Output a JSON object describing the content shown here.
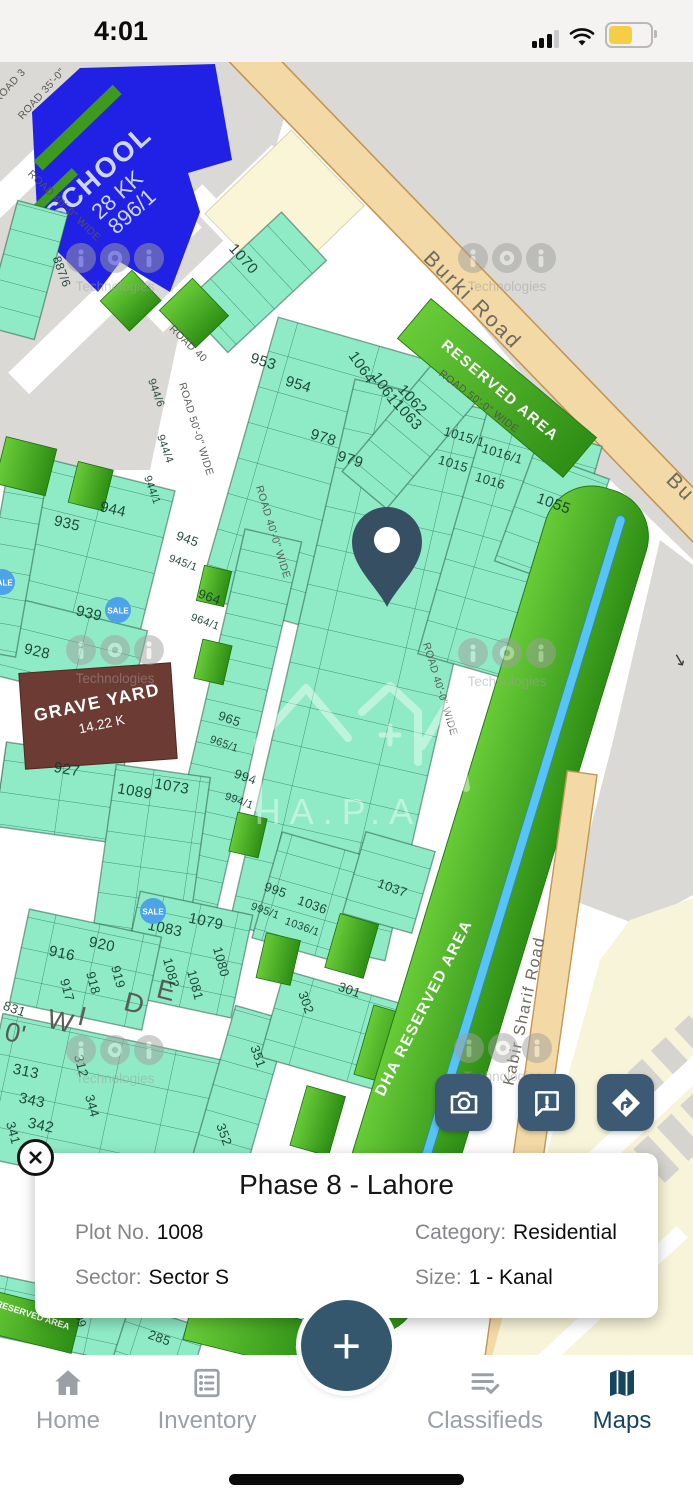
{
  "status_bar": {
    "time": "4:01"
  },
  "map": {
    "plots": [
      "1070",
      "953",
      "954",
      "1064",
      "1061",
      "1062",
      "1063",
      "978",
      "979",
      "1015/1",
      "1016/1",
      "1015",
      "1016",
      "1055",
      "935",
      "944",
      "939",
      "928",
      "945",
      "945/1",
      "964",
      "964/1",
      "965",
      "965/1",
      "994",
      "994/1",
      "995",
      "995/1",
      "1036",
      "1036/1",
      "1037",
      "927",
      "1089",
      "1073",
      "916",
      "920",
      "917",
      "918",
      "919",
      "1083",
      "1079",
      "1082",
      "1081",
      "1080",
      "831",
      "313",
      "343",
      "342",
      "341",
      "312",
      "344",
      "302",
      "301",
      "351",
      "352",
      "285",
      "409",
      "887/6",
      "944/6",
      "944/4",
      "944/1"
    ],
    "road_labels": [
      "ROAD 3",
      "ROAD 35'-0\"",
      "ROAD 40'-0\" WIDE",
      "ROAD 40",
      "ROAD 50'-0\" WIDE",
      "ROAD 50'-0\" WIDE",
      "ROAD 40'-0\" WIDE",
      "ROAD 40'-0\" WIDE"
    ],
    "big_letters": [
      "0'",
      "W",
      "I",
      "D",
      "E"
    ],
    "burki_road": "Burki Road",
    "burki_road_clipped": "Bu",
    "kabir_road": "Kabir Sharif Road",
    "school": {
      "name": "SCHOOL",
      "line2": "28 KK",
      "line3": "896/1"
    },
    "graveyard": {
      "name": "GRAVE YARD",
      "size": "14.22 K"
    },
    "reserved_area": "RESERVED AREA",
    "dha_reserved_area": "DHA RESERVED AREA",
    "reserved_area_small": "RESERVED AREA",
    "sale_badge": "SALE",
    "watermark_caption": "Technologies",
    "center_watermark_caption": "HA.P.As",
    "direction_arrow": "↘"
  },
  "info_card": {
    "title": "Phase 8 - Lahore",
    "plot_label": "Plot No.",
    "plot_value": "1008",
    "category_label": "Category:",
    "category_value": "Residential",
    "sector_label": "Sector:",
    "sector_value": "Sector S",
    "size_label": "Size:",
    "size_value": "1 - Kanal"
  },
  "fab_label": "+",
  "nav": {
    "items": [
      "Home",
      "Inventory",
      "Classifieds",
      "Maps"
    ]
  }
}
